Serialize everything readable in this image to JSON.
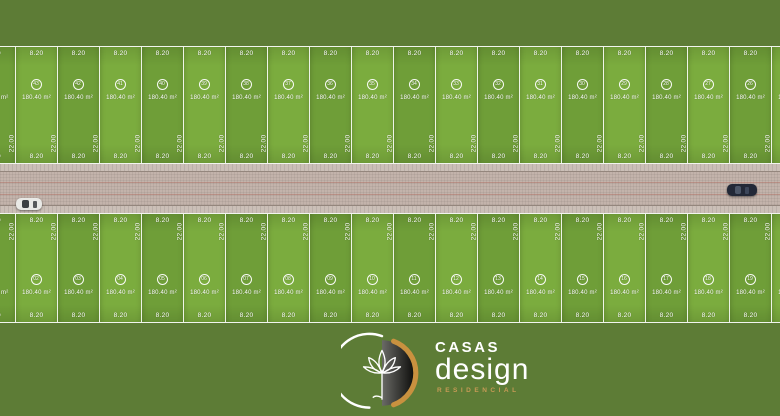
{
  "title": "Casas Design Residencial — subdivision site plan",
  "site_plan": {
    "lot": {
      "front_dimension": "8.20",
      "side_dimension": "22.00",
      "area": "180.40 m²"
    },
    "top_row": [
      "44",
      "43",
      "42",
      "41",
      "40",
      "39",
      "38",
      "37",
      "36",
      "35",
      "34",
      "33",
      "32",
      "31",
      "30",
      "29",
      "28",
      "27",
      "26",
      "25"
    ],
    "bottom_row": [
      "01",
      "02",
      "03",
      "04",
      "05",
      "06",
      "07",
      "08",
      "09",
      "10",
      "11",
      "12",
      "13",
      "14",
      "15",
      "16",
      "17",
      "18",
      "19",
      "20"
    ]
  },
  "road": {
    "vehicles": [
      {
        "icon": "white-car-icon",
        "side": "left"
      },
      {
        "icon": "dark-car-icon",
        "side": "right"
      }
    ]
  },
  "logo": {
    "icon": "lotus-flower-icon",
    "name_top": "CASAS",
    "name_main": "design",
    "subtitle": "RESIDENCIAL"
  },
  "colors": {
    "grass": "#5d7c36",
    "lot_light": "#7bac3e",
    "lot_dark": "#6f9e38",
    "lot_line": "#ffffff",
    "road": "#c3b3ab",
    "sidewalk": "#cbbfb7",
    "logo_gold": "#c9913f",
    "subtitle_gold": "#c69a55"
  }
}
